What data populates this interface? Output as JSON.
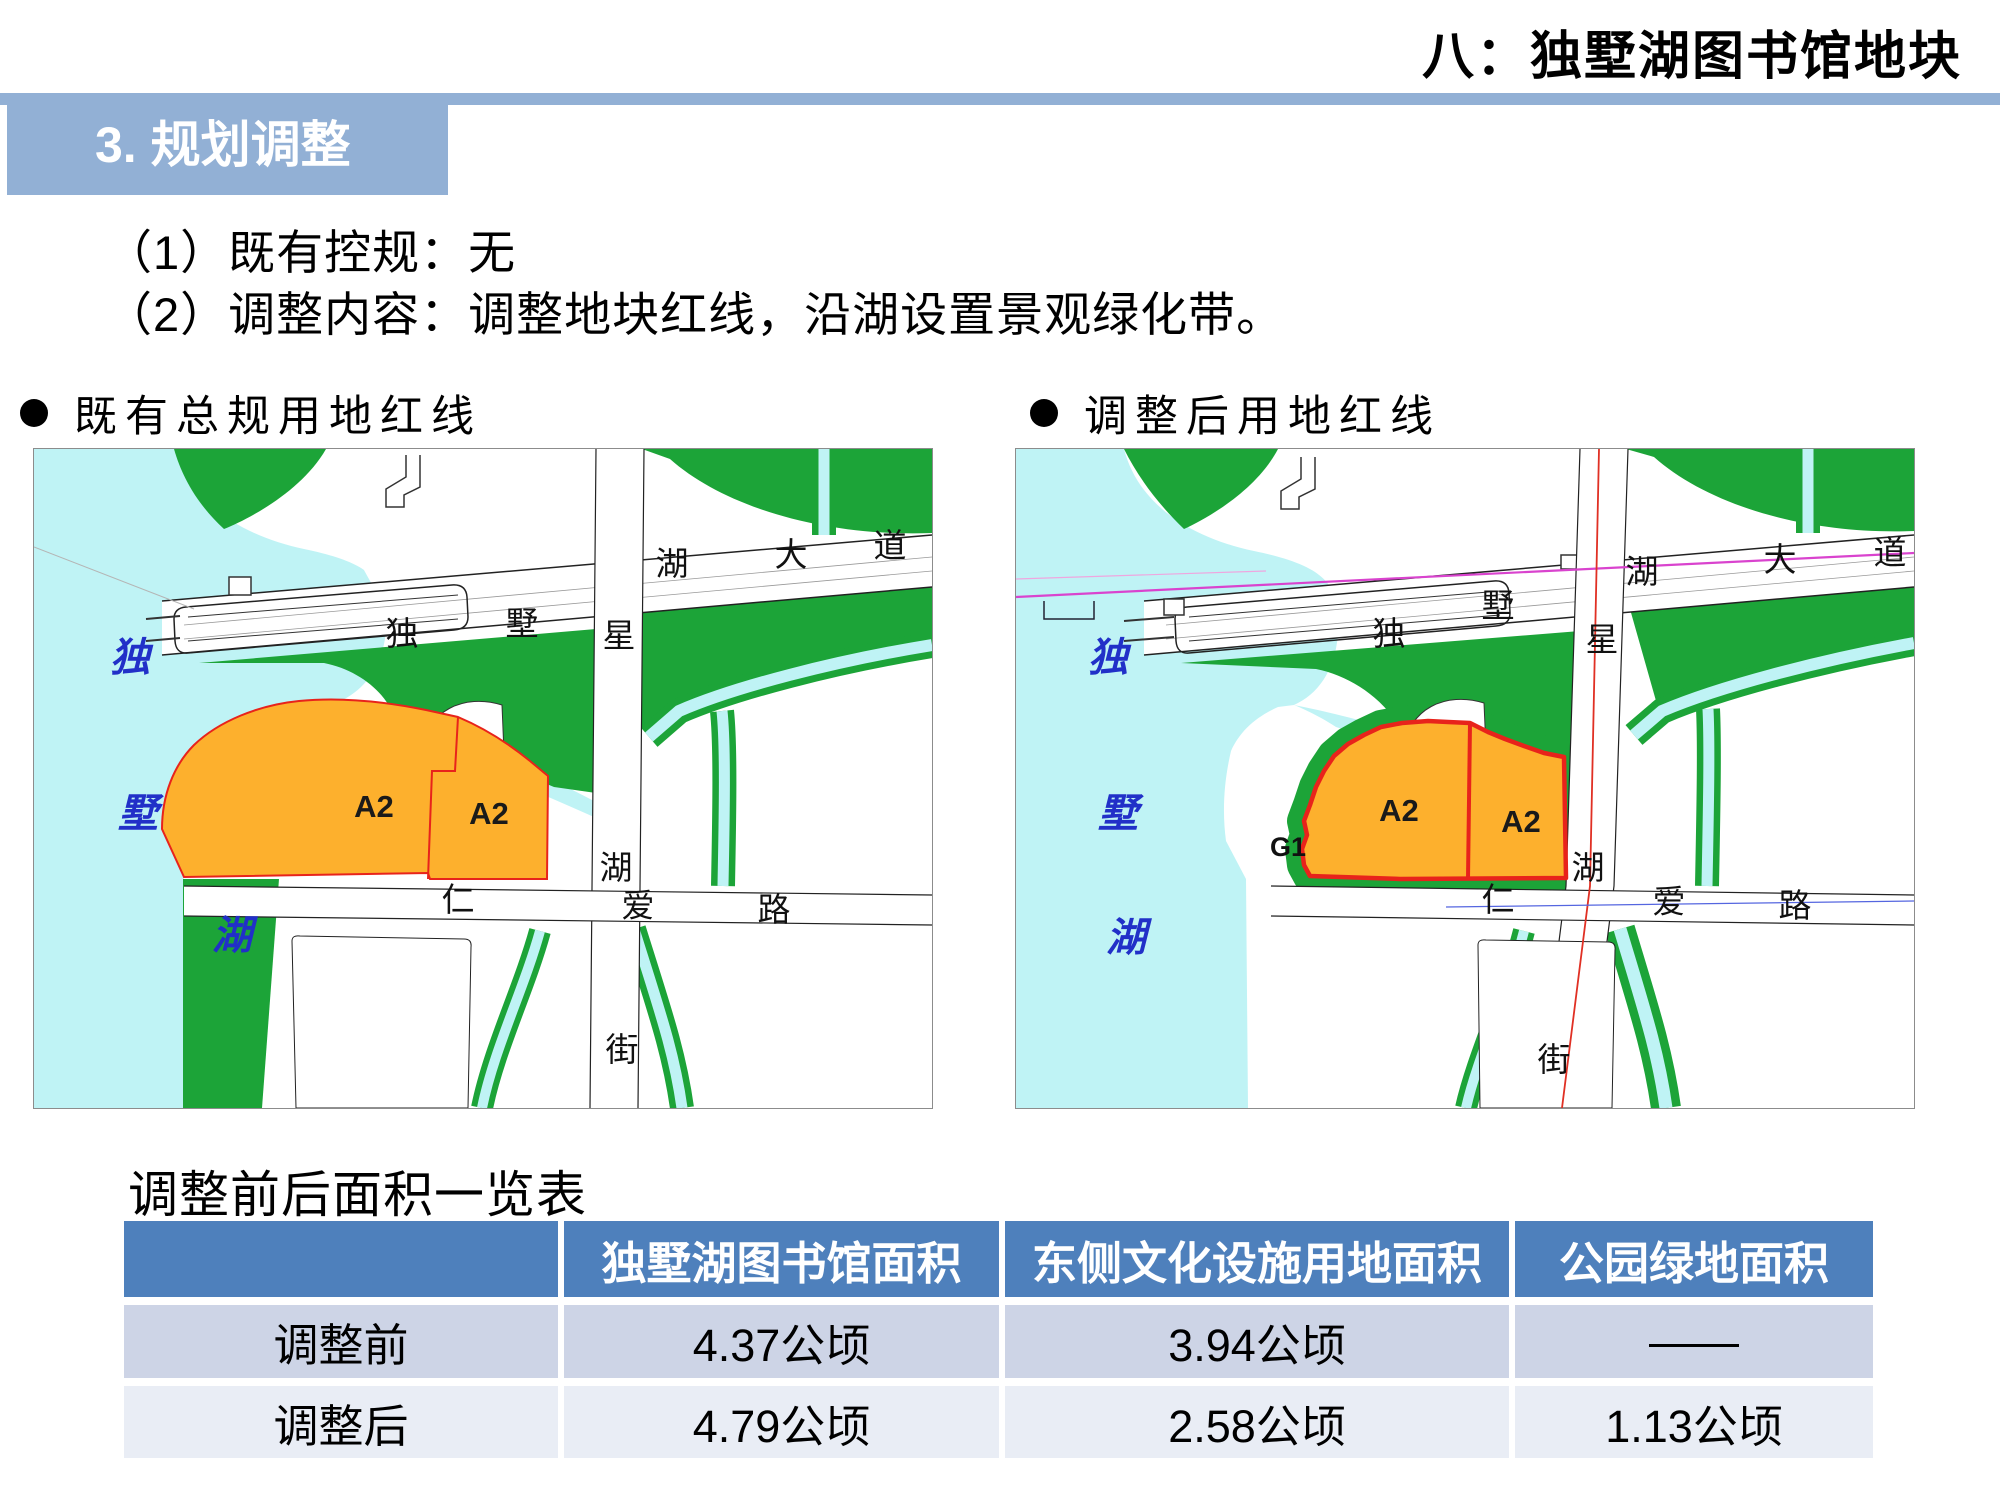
{
  "page": {
    "corner_title": "八：独墅湖图书馆地块",
    "section_title": "3. 规划调整",
    "paragraphs": [
      "（1）既有控规：无",
      "（2）调整内容：调整地块红线，沿湖设置景观绿化带。"
    ],
    "bullets": {
      "left": "既有总规用地红线",
      "right": "调整后用地红线"
    }
  },
  "maps": {
    "left": {
      "road_h": [
        "独",
        "墅",
        "湖",
        "大",
        "道"
      ],
      "road_v": [
        "星",
        "湖",
        "街"
      ],
      "road_renai": [
        "仁",
        "爱",
        "路"
      ],
      "lake": [
        "独",
        "墅",
        "湖"
      ],
      "parcels": [
        "A2",
        "A2"
      ]
    },
    "right": {
      "road_h": [
        "独",
        "墅",
        "湖",
        "大",
        "道"
      ],
      "road_v": [
        "星",
        "湖",
        "街"
      ],
      "road_renai": [
        "仁",
        "爱",
        "路"
      ],
      "lake": [
        "独",
        "墅",
        "湖"
      ],
      "parcels": [
        "A2",
        "A2"
      ],
      "green_label": "G1"
    }
  },
  "table": {
    "title": "调整前后面积一览表",
    "headers": [
      "",
      "独墅湖图书馆面积",
      "东侧文化设施用地面积",
      "公园绿地面积"
    ],
    "rows": [
      {
        "label": "调整前",
        "values": [
          "4.37公顷",
          "3.94公顷",
          "——"
        ]
      },
      {
        "label": "调整后",
        "values": [
          "4.79公顷",
          "2.58公顷",
          "1.13公顷"
        ]
      }
    ]
  },
  "colors": {
    "banner": "#92B0D5",
    "header_blue": "#4E80BC",
    "row_odd": "#CDD4E6",
    "row_even": "#E9EDF5",
    "water": "#BFF3F5",
    "green": "#1CA438",
    "parcel_orange": "#FDB02D",
    "red_line": "#E8231B",
    "magenta": "#D943CE",
    "lake_label_blue": "#2130C8"
  }
}
